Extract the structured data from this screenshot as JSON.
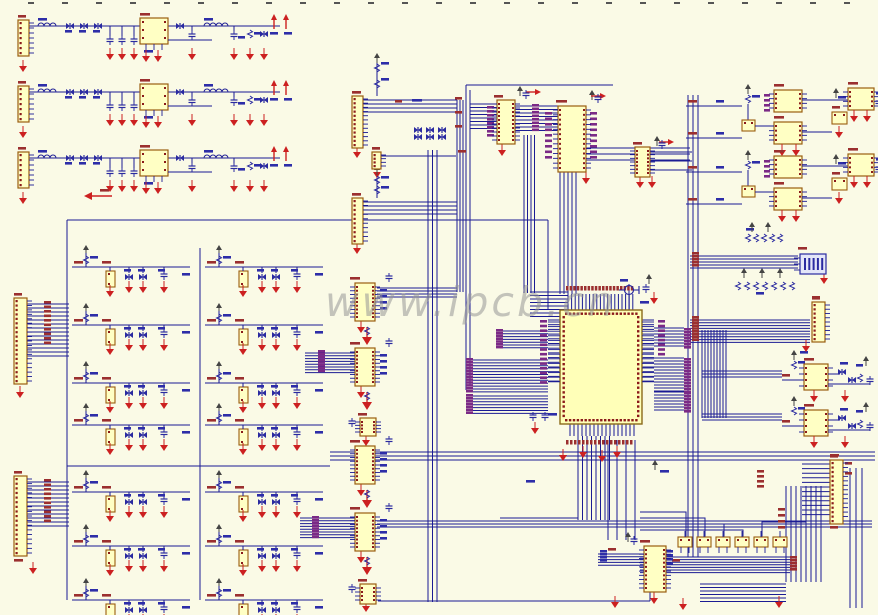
{
  "watermark": {
    "text": "www.ipcb.cn"
  },
  "colors": {
    "bg": "#FAFAE6",
    "wire": "#1b1b94",
    "comp_fill": "#FFFFC4",
    "comp_stroke": "#9a5d10",
    "pin": "#8b1a1a",
    "red": "#cc2020",
    "lbl_red": "#9b2f2f",
    "lbl_blue": "#2d2da8",
    "lbl_purple": "#7b2a86",
    "blue_sym": "#2a2aa0",
    "tick": "#555555",
    "watermark": "#969696"
  },
  "schematic": {
    "topticks": {
      "y": 2,
      "x0": 28,
      "dx": 34,
      "n": 25
    },
    "psu": [
      [
        12,
        14
      ],
      [
        12,
        80
      ],
      [
        12,
        146
      ]
    ],
    "fcell": [
      [
        72,
        245
      ],
      [
        205,
        245
      ],
      [
        72,
        303
      ],
      [
        205,
        303
      ],
      [
        72,
        361
      ],
      [
        205,
        361
      ],
      [
        72,
        403
      ],
      [
        205,
        403
      ],
      [
        72,
        470
      ],
      [
        205,
        470
      ],
      [
        72,
        524
      ],
      [
        205,
        524
      ],
      [
        72,
        578
      ],
      [
        205,
        578
      ]
    ],
    "conn": [
      [
        14,
        298,
        13,
        86,
        19
      ],
      [
        14,
        476,
        13,
        80,
        17
      ],
      [
        352,
        96,
        11,
        52,
        12
      ],
      [
        352,
        198,
        11,
        46,
        10
      ],
      [
        372,
        152,
        9,
        17,
        4
      ],
      [
        812,
        302,
        13,
        40,
        9
      ],
      [
        830,
        460,
        13,
        64,
        14
      ]
    ],
    "dip": [
      [
        497,
        100,
        18,
        44,
        10
      ],
      [
        558,
        106,
        28,
        66,
        13
      ],
      [
        635,
        147,
        15,
        30,
        7
      ],
      [
        355,
        283,
        20,
        38,
        9
      ],
      [
        355,
        348,
        20,
        38,
        9
      ],
      [
        355,
        446,
        20,
        38,
        9
      ],
      [
        355,
        513,
        20,
        38,
        9
      ],
      [
        644,
        546,
        22,
        46,
        10
      ]
    ],
    "sdip": [
      [
        360,
        418,
        16,
        18,
        4
      ],
      [
        360,
        584,
        16,
        20,
        4
      ]
    ],
    "qfp": [
      560,
      310,
      82,
      114
    ],
    "box": [
      [
        678,
        537,
        14,
        10
      ],
      [
        697,
        537,
        14,
        10
      ],
      [
        716,
        537,
        14,
        10
      ],
      [
        735,
        537,
        14,
        10
      ],
      [
        754,
        537,
        14,
        10
      ],
      [
        773,
        537,
        14,
        10
      ]
    ],
    "amp": [
      [
        686,
        84
      ],
      [
        686,
        150
      ]
    ],
    "opamp": [
      [
        782,
        350
      ],
      [
        782,
        396
      ]
    ],
    "bluepart": [
      800,
      254
    ],
    "xtal": [
      629,
      290
    ],
    "bus": [
      [
        27,
        304,
        14,
        4,
        42,
        "h"
      ],
      [
        27,
        482,
        12,
        4,
        42,
        "h"
      ],
      [
        363,
        100,
        4,
        4,
        94,
        "h"
      ],
      [
        363,
        202,
        4,
        4,
        94,
        "h"
      ],
      [
        305,
        353,
        8,
        2.8,
        50,
        "h"
      ],
      [
        300,
        518,
        8,
        2.8,
        55,
        "h"
      ],
      [
        377,
        288,
        4,
        3,
        80,
        "h"
      ],
      [
        377,
        521,
        3,
        3,
        495,
        "h"
      ],
      [
        428,
        150,
        3,
        4.5,
        452,
        "v"
      ],
      [
        457,
        100,
        4,
        3,
        192,
        "v"
      ],
      [
        330,
        452,
        3,
        4,
        545,
        "h"
      ],
      [
        470,
        104,
        8,
        3.5,
        27,
        "h"
      ],
      [
        515,
        106,
        8,
        3.5,
        43,
        "h"
      ],
      [
        586,
        148,
        3,
        6,
        104,
        "h"
      ],
      [
        524,
        135,
        4,
        3.5,
        158,
        "v"
      ],
      [
        560,
        172,
        5,
        4,
        122,
        "v"
      ],
      [
        530,
        292,
        8,
        3.5,
        38,
        "h"
      ],
      [
        568,
        294,
        19,
        3.6,
        16,
        "v"
      ],
      [
        570,
        424,
        17,
        4,
        12,
        "v"
      ],
      [
        548,
        320,
        14,
        4.7,
        12,
        "h"
      ],
      [
        642,
        320,
        14,
        4.7,
        12,
        "h"
      ],
      [
        500,
        331,
        7,
        2.8,
        48,
        "h"
      ],
      [
        472,
        360,
        12,
        2.9,
        76,
        "h"
      ],
      [
        472,
        396,
        7,
        2.9,
        76,
        "h"
      ],
      [
        654,
        328,
        7,
        3,
        30,
        "h"
      ],
      [
        654,
        358,
        12,
        3,
        30,
        "h"
      ],
      [
        654,
        392,
        7,
        3,
        30,
        "h"
      ],
      [
        702,
        330,
        9,
        3,
        88,
        "v"
      ],
      [
        702,
        371,
        3,
        3,
        80,
        "h"
      ],
      [
        702,
        414,
        3,
        3,
        80,
        "h"
      ],
      [
        690,
        256,
        5,
        3,
        108,
        "h"
      ],
      [
        690,
        320,
        9,
        2.8,
        120,
        "h"
      ],
      [
        578,
        436,
        8,
        4.5,
        84,
        "v"
      ],
      [
        500,
        518,
        4,
        3,
        78,
        "h"
      ],
      [
        598,
        554,
        5,
        2.8,
        46,
        "h"
      ],
      [
        640,
        557,
        7,
        2.6,
        150,
        "h"
      ],
      [
        802,
        464,
        12,
        4.6,
        28,
        "h"
      ],
      [
        786,
        486,
        8,
        5,
        96,
        "v"
      ],
      [
        700,
        584,
        6,
        3.5,
        86,
        "h"
      ],
      [
        850,
        468,
        3,
        6,
        140,
        "v"
      ],
      [
        688,
        95,
        3,
        5,
        462,
        "v"
      ],
      [
        608,
        440,
        4,
        9,
        100,
        "v"
      ]
    ],
    "wire": [
      [
        [
          67,
          220
        ],
        [
          548,
          220
        ]
      ],
      [
        [
          67,
          220
        ],
        [
          67,
          600
        ]
      ],
      [
        [
          200,
          248
        ],
        [
          200,
          600
        ]
      ],
      [
        [
          548,
          220
        ],
        [
          548,
          310
        ]
      ],
      [
        [
          466,
          85
        ],
        [
          613,
          85
        ]
      ],
      [
        [
          466,
          85
        ],
        [
          466,
          390
        ]
      ],
      [
        [
          470,
          90
        ],
        [
          470,
          386
        ]
      ],
      [
        [
          650,
          152
        ],
        [
          692,
          152
        ]
      ],
      [
        [
          650,
          161
        ],
        [
          692,
          161
        ]
      ],
      [
        [
          650,
          170
        ],
        [
          692,
          170
        ]
      ],
      [
        [
          378,
          601
        ],
        [
          650,
          601
        ]
      ],
      [
        [
          629,
          284
        ],
        [
          629,
          310
        ]
      ],
      [
        [
          381,
          156
        ],
        [
          456,
          156
        ]
      ],
      [
        [
          377,
          58
        ],
        [
          377,
          96
        ]
      ],
      [
        [
          377,
          170
        ],
        [
          377,
          198
        ]
      ],
      [
        [
          67,
          466
        ],
        [
          330,
          466
        ]
      ],
      [
        [
          686,
          537
        ],
        [
          686,
          512
        ],
        [
          640,
          512
        ]
      ],
      [
        [
          705,
          537
        ],
        [
          705,
          518
        ],
        [
          640,
          518
        ]
      ],
      [
        [
          724,
          537
        ],
        [
          724,
          524
        ],
        [
          640,
          524
        ]
      ],
      [
        [
          743,
          537
        ],
        [
          743,
          530
        ],
        [
          640,
          530
        ]
      ],
      [
        [
          762,
          537
        ],
        [
          762,
          522
        ],
        [
          806,
          522
        ],
        [
          806,
          500
        ]
      ],
      [
        [
          650,
          592
        ],
        [
          650,
          601
        ]
      ]
    ],
    "lblcol": [
      [
        44,
        301,
        10,
        4.5,
        "red",
        "v"
      ],
      [
        44,
        479,
        10,
        4.5,
        "red",
        "v"
      ],
      [
        455,
        97,
        3,
        14,
        "red",
        "v"
      ],
      [
        487,
        106,
        8,
        4,
        "purple",
        "v"
      ],
      [
        532,
        104,
        8,
        3.5,
        "purple",
        "v"
      ],
      [
        545,
        112,
        9,
        5.5,
        "purple",
        "v"
      ],
      [
        590,
        112,
        9,
        5.5,
        "purple",
        "v"
      ],
      [
        566,
        286,
        19,
        3.6,
        "red",
        "h"
      ],
      [
        566,
        440,
        17,
        4,
        "red",
        "h"
      ],
      [
        540,
        320,
        14,
        4.7,
        "purple",
        "v"
      ],
      [
        658,
        320,
        8,
        4.7,
        "purple",
        "v"
      ],
      [
        684,
        328,
        7,
        3,
        "purple",
        "v"
      ],
      [
        684,
        358,
        12,
        3,
        "purple",
        "v"
      ],
      [
        684,
        392,
        7,
        3,
        "purple",
        "v"
      ],
      [
        496,
        329,
        7,
        2.8,
        "purple",
        "v"
      ],
      [
        466,
        358,
        12,
        2.9,
        "purple",
        "v"
      ],
      [
        466,
        394,
        7,
        2.9,
        "purple",
        "v"
      ],
      [
        692,
        252,
        5,
        3,
        "red",
        "v"
      ],
      [
        692,
        316,
        9,
        2.8,
        "red",
        "v"
      ],
      [
        778,
        508,
        4,
        6,
        "red",
        "v"
      ],
      [
        790,
        556,
        5,
        3,
        "red",
        "v"
      ],
      [
        600,
        550,
        4,
        3,
        "blue",
        "v"
      ],
      [
        318,
        350,
        8,
        2.8,
        "purple",
        "v"
      ],
      [
        312,
        516,
        8,
        2.8,
        "purple",
        "v"
      ],
      [
        380,
        289,
        4,
        6,
        "blue",
        "v"
      ],
      [
        380,
        354,
        4,
        6,
        "blue",
        "v"
      ],
      [
        380,
        452,
        4,
        6,
        "blue",
        "v"
      ],
      [
        380,
        519,
        4,
        6,
        "blue",
        "v"
      ],
      [
        666,
        550,
        4,
        4,
        "blue",
        "v"
      ],
      [
        845,
        462,
        2,
        10,
        "red",
        "v"
      ],
      [
        757,
        470,
        4,
        5,
        "red",
        "v"
      ]
    ],
    "lbl": [
      [
        352,
        91,
        "red",
        9
      ],
      [
        352,
        193,
        "red",
        9
      ],
      [
        372,
        147,
        "red",
        8
      ],
      [
        350,
        277,
        "red",
        10
      ],
      [
        350,
        342,
        "red",
        10
      ],
      [
        350,
        440,
        "red",
        10
      ],
      [
        350,
        507,
        "red",
        10
      ],
      [
        358,
        413,
        "red",
        9
      ],
      [
        358,
        579,
        "red",
        9
      ],
      [
        494,
        95,
        "red",
        9
      ],
      [
        556,
        100,
        "red",
        11
      ],
      [
        633,
        142,
        "red",
        9
      ],
      [
        640,
        540,
        "red",
        10
      ],
      [
        608,
        548,
        "red",
        8
      ],
      [
        812,
        296,
        "red",
        8
      ],
      [
        798,
        247,
        "red",
        9
      ],
      [
        830,
        454,
        "red",
        9
      ],
      [
        830,
        526,
        "red",
        8
      ],
      [
        100,
        189,
        "red",
        9
      ],
      [
        14,
        559,
        "red",
        9
      ],
      [
        458,
        150,
        "red",
        8
      ],
      [
        672,
        559,
        "red",
        8
      ],
      [
        395,
        100,
        "red",
        7
      ],
      [
        412,
        99,
        "blue",
        10
      ],
      [
        660,
        470,
        "blue",
        9
      ],
      [
        548,
        413,
        "blue",
        9
      ],
      [
        640,
        301,
        "blue",
        9
      ],
      [
        620,
        279,
        "blue",
        8
      ],
      [
        800,
        351,
        "blue",
        8
      ],
      [
        381,
        62,
        "blue",
        8
      ],
      [
        381,
        78,
        "blue",
        8
      ],
      [
        381,
        176,
        "blue",
        8
      ],
      [
        381,
        186,
        "blue",
        8
      ],
      [
        526,
        480,
        "blue",
        9
      ],
      [
        746,
        228,
        "blue",
        8
      ],
      [
        756,
        292,
        "blue",
        8
      ]
    ],
    "gnd": [
      [
        20,
        392
      ],
      [
        33,
        568
      ],
      [
        357,
        152
      ],
      [
        357,
        248
      ],
      [
        377,
        172
      ],
      [
        806,
        346
      ],
      [
        361,
        327
      ],
      [
        361,
        392
      ],
      [
        361,
        490
      ],
      [
        361,
        557
      ],
      [
        366,
        440
      ],
      [
        366,
        606
      ],
      [
        502,
        150
      ],
      [
        586,
        178
      ],
      [
        640,
        182
      ],
      [
        652,
        182
      ],
      [
        654,
        598
      ],
      [
        615,
        602
      ],
      [
        563,
        455
      ],
      [
        583,
        452
      ],
      [
        602,
        456
      ],
      [
        617,
        452
      ],
      [
        535,
        428
      ],
      [
        824,
        278
      ],
      [
        683,
        604
      ],
      [
        779,
        602
      ],
      [
        654,
        298
      ]
    ],
    "bigarrow": [
      [
        367,
        337
      ],
      [
        367,
        402
      ],
      [
        367,
        500
      ],
      [
        367,
        567
      ]
    ],
    "vcc": [
      [
        377,
        55
      ],
      [
        377,
        167
      ],
      [
        520,
        88
      ],
      [
        592,
        92
      ],
      [
        657,
        138
      ],
      [
        628,
        534
      ],
      [
        752,
        224
      ],
      [
        768,
        224
      ],
      [
        649,
        276
      ],
      [
        655,
        462
      ],
      [
        744,
        270
      ],
      [
        762,
        270
      ],
      [
        780,
        270
      ]
    ],
    "pwr": [
      [
        535,
        92,
        "r"
      ],
      [
        600,
        96,
        "r"
      ],
      [
        668,
        142,
        "r"
      ],
      [
        92,
        196,
        "l"
      ]
    ],
    "res": [
      [
        377,
        64
      ],
      [
        377,
        80
      ],
      [
        377,
        176
      ],
      [
        377,
        186
      ],
      [
        748,
        234
      ],
      [
        756,
        234
      ],
      [
        764,
        234
      ],
      [
        772,
        234
      ],
      [
        780,
        234
      ],
      [
        738,
        282
      ],
      [
        747,
        282
      ],
      [
        756,
        282
      ],
      [
        765,
        282
      ],
      [
        774,
        282
      ],
      [
        783,
        282
      ],
      [
        792,
        282
      ],
      [
        367,
        327
      ],
      [
        367,
        392
      ],
      [
        367,
        490
      ],
      [
        367,
        557
      ]
    ],
    "cap": [
      [
        389,
        277
      ],
      [
        389,
        342
      ],
      [
        389,
        440
      ],
      [
        389,
        507
      ],
      [
        526,
        94
      ],
      [
        598,
        98
      ],
      [
        662,
        144
      ],
      [
        634,
        540
      ],
      [
        352,
        422
      ],
      [
        352,
        588
      ],
      [
        533,
        416
      ],
      [
        545,
        416
      ],
      [
        646,
        288
      ]
    ],
    "diode": [
      [
        418,
        130
      ],
      [
        430,
        130
      ],
      [
        442,
        130
      ],
      [
        418,
        137
      ],
      [
        430,
        137
      ],
      [
        442,
        137
      ]
    ]
  }
}
